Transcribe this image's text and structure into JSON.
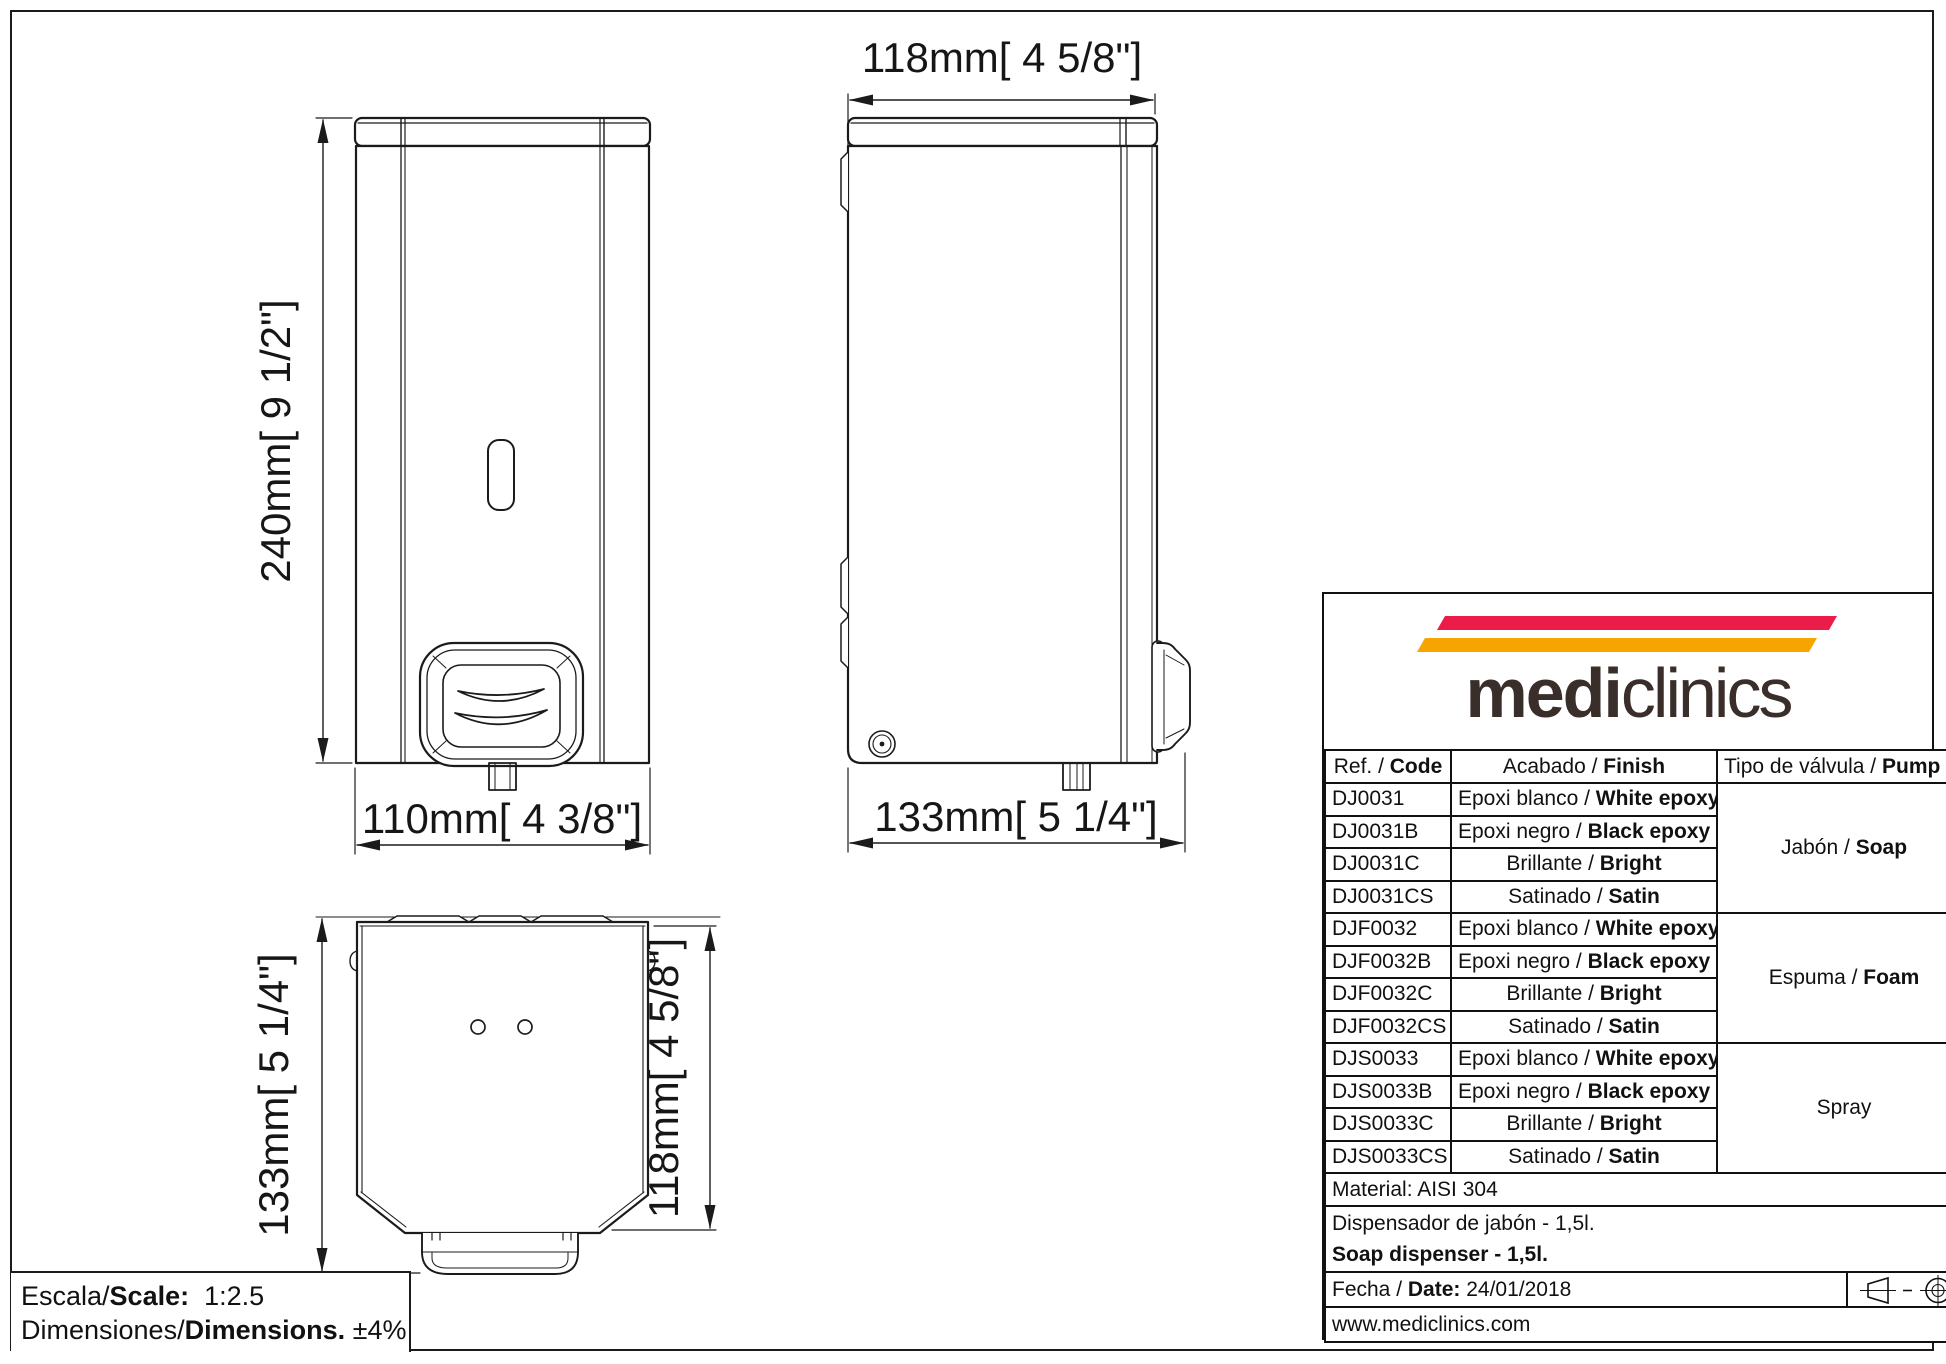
{
  "drawing": {
    "views": {
      "front": {
        "name": "front view",
        "dim_height": "240mm[ 9 1/2\"]",
        "dim_width": "110mm[ 4 3/8\"]"
      },
      "side": {
        "name": "side view",
        "dim_top": "118mm[ 4 5/8\"]",
        "dim_bottom": "133mm[ 5 1/4\"]"
      },
      "top": {
        "name": "top view",
        "dim_left": "133mm[ 5 1/4\"]",
        "dim_right": "118mm[ 4 5/8\"]"
      }
    },
    "scale_box": {
      "line1_pre": "Escala/",
      "line1_bold": "Scale:",
      "line1_value": "  1:2.5",
      "line2_pre": "Dimensiones/",
      "line2_bold": "Dimensions.",
      "line2_value": " ±4%"
    }
  },
  "title_block": {
    "logo": {
      "text_bold": "medi",
      "text_light": "clinics",
      "stripe_red": "#EC1C4A",
      "stripe_yellow": "#F6A500",
      "text_color": "#3A2E2A"
    },
    "header": {
      "col1_pre": "Ref. / ",
      "col1_bold": "Code",
      "col2_pre": "Acabado / ",
      "col2_bold": "Finish",
      "col3_pre": "Tipo de válvula / ",
      "col3_bold": "Pump type"
    },
    "rows": [
      {
        "code": "DJ0031",
        "finish_pre": "Epoxi blanco / ",
        "finish_bold": "White epoxy"
      },
      {
        "code": "DJ0031B",
        "finish_pre": "Epoxi negro / ",
        "finish_bold": "Black epoxy"
      },
      {
        "code": "DJ0031C",
        "finish_pre": "Brillante / ",
        "finish_bold": "Bright"
      },
      {
        "code": "DJ0031CS",
        "finish_pre": "Satinado / ",
        "finish_bold": "Satin"
      },
      {
        "code": "DJF0032",
        "finish_pre": "Epoxi blanco / ",
        "finish_bold": "White epoxy"
      },
      {
        "code": "DJF0032B",
        "finish_pre": "Epoxi negro / ",
        "finish_bold": "Black epoxy"
      },
      {
        "code": "DJF0032C",
        "finish_pre": "Brillante / ",
        "finish_bold": "Bright"
      },
      {
        "code": "DJF0032CS",
        "finish_pre": "Satinado / ",
        "finish_bold": "Satin"
      },
      {
        "code": "DJS0033",
        "finish_pre": "Epoxi blanco / ",
        "finish_bold": "White epoxy"
      },
      {
        "code": "DJS0033B",
        "finish_pre": "Epoxi negro / ",
        "finish_bold": "Black epoxy"
      },
      {
        "code": "DJS0033C",
        "finish_pre": "Brillante / ",
        "finish_bold": "Bright"
      },
      {
        "code": "DJS0033CS",
        "finish_pre": "Satinado / ",
        "finish_bold": "Satin"
      }
    ],
    "pump_groups": [
      {
        "pre": "Jabón / ",
        "bold": "Soap"
      },
      {
        "pre": "Espuma / ",
        "bold": "Foam"
      },
      {
        "pre": "Spray",
        "bold": ""
      }
    ],
    "material": "Material: AISI 304",
    "product_line1": "Dispensador de jabón - 1,5l.",
    "product_line2": "Soap dispenser - 1,5l.",
    "date_pre": "Fecha / ",
    "date_bold": "Date:",
    "date_value": " 24/01/2018",
    "website": "www.mediclinics.com"
  }
}
